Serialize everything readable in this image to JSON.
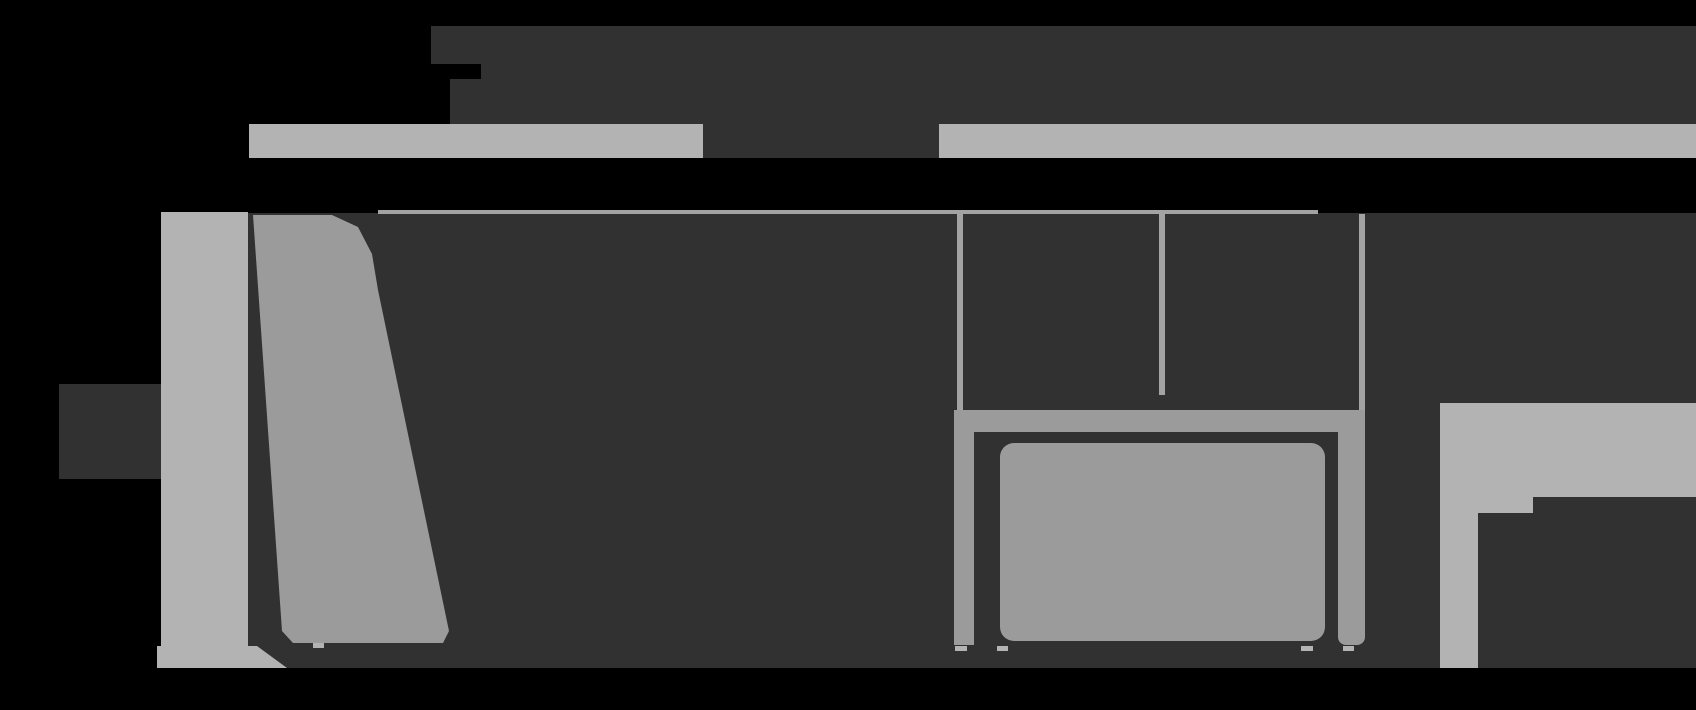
{
  "figure": {
    "kind": "product-dimension-diagram",
    "subject": "chair dimensions drawing, extreme zoom crop: side view at left, front view at right, dimension bars top and left, no legible text",
    "width_px": 1696,
    "height_px": 710
  },
  "colors": {
    "background": "#000000",
    "dark": "#313131",
    "light": "#b3b3b3",
    "mid": "#9b9b9b",
    "line": "#a3a3a3"
  },
  "elements": {
    "top_label_band_row1": {
      "shape": "rect",
      "x": 431,
      "y": 26,
      "w": 1265,
      "h": 38,
      "c": "dark"
    },
    "top_label_band_row2": {
      "shape": "rect",
      "x": 481,
      "y": 64,
      "w": 1215,
      "h": 15,
      "c": "dark"
    },
    "top_label_band_row3": {
      "shape": "rect",
      "x": 450,
      "y": 79,
      "w": 1246,
      "h": 45,
      "c": "dark"
    },
    "width_bar_left": {
      "shape": "rect",
      "x": 249,
      "y": 124,
      "w": 454,
      "h": 34,
      "c": "light"
    },
    "width_bar_gap": {
      "shape": "rect",
      "x": 703,
      "y": 124,
      "w": 236,
      "h": 34,
      "c": "dark"
    },
    "width_bar_right": {
      "shape": "rect",
      "x": 939,
      "y": 124,
      "w": 757,
      "h": 34,
      "c": "light"
    },
    "drawing_canvas": {
      "shape": "rect",
      "x": 246,
      "y": 213,
      "w": 1450,
      "h": 455,
      "c": "dark"
    },
    "height_label_blob": {
      "shape": "rect",
      "x": 59,
      "y": 384,
      "w": 105,
      "h": 95,
      "c": "dark"
    },
    "height_bar": {
      "shape": "polygon",
      "c": "light",
      "points": "161,212 248,212 248,646 257,646 287,668 157,668 157,646 161,646"
    },
    "backrest_side_view": {
      "shape": "polygon",
      "c": "mid",
      "points": "253,215 332,215 358,227 372,254 378,290 449,631 443,643 293,643 282,631"
    },
    "canvas_top_edge_line": {
      "shape": "rect",
      "x": 378,
      "y": 210,
      "w": 940,
      "h": 4,
      "c": "line"
    },
    "frame_line_left": {
      "shape": "rect",
      "x": 957,
      "y": 214,
      "w": 6,
      "h": 223,
      "c": "line"
    },
    "frame_line_mid": {
      "shape": "rect",
      "x": 1159,
      "y": 214,
      "w": 6,
      "h": 181,
      "c": "line"
    },
    "frame_line_right": {
      "shape": "rect",
      "x": 1359,
      "y": 214,
      "w": 6,
      "h": 226,
      "c": "line"
    },
    "seat_frame_top_band": {
      "shape": "rect",
      "x": 968,
      "y": 410,
      "w": 379,
      "h": 22,
      "c": "mid"
    },
    "seat_frame_left_band": {
      "shape": "rect",
      "x": 954,
      "y": 410,
      "w": 20,
      "h": 235,
      "c": "mid"
    },
    "seat_frame_right_band": {
      "shape": "rect",
      "x": 1338,
      "y": 410,
      "w": 27,
      "h": 235,
      "c": "mid",
      "r": "0 0 8px 8px"
    },
    "seat_cushion": {
      "shape": "rect",
      "x": 1000,
      "y": 443,
      "w": 325,
      "h": 198,
      "c": "mid",
      "r": "14px"
    },
    "right_light_block": {
      "shape": "rect",
      "x": 1440,
      "y": 403,
      "w": 256,
      "h": 94,
      "c": "light"
    },
    "right_light_bar": {
      "shape": "rect",
      "x": 1440,
      "y": 497,
      "w": 38,
      "h": 171,
      "c": "light"
    },
    "right_light_step": {
      "shape": "rect",
      "x": 1478,
      "y": 497,
      "w": 55,
      "h": 16,
      "c": "light"
    },
    "side_view_foot": {
      "shape": "rect",
      "x": 313,
      "y": 643,
      "w": 11,
      "h": 5,
      "c": "light"
    },
    "front_foot_1": {
      "shape": "rect",
      "x": 955,
      "y": 646,
      "w": 12,
      "h": 5,
      "c": "light"
    },
    "front_foot_2": {
      "shape": "rect",
      "x": 997,
      "y": 646,
      "w": 11,
      "h": 5,
      "c": "light"
    },
    "front_foot_3": {
      "shape": "rect",
      "x": 1301,
      "y": 646,
      "w": 12,
      "h": 5,
      "c": "light"
    },
    "front_foot_4": {
      "shape": "rect",
      "x": 1343,
      "y": 646,
      "w": 11,
      "h": 5,
      "c": "light"
    }
  }
}
